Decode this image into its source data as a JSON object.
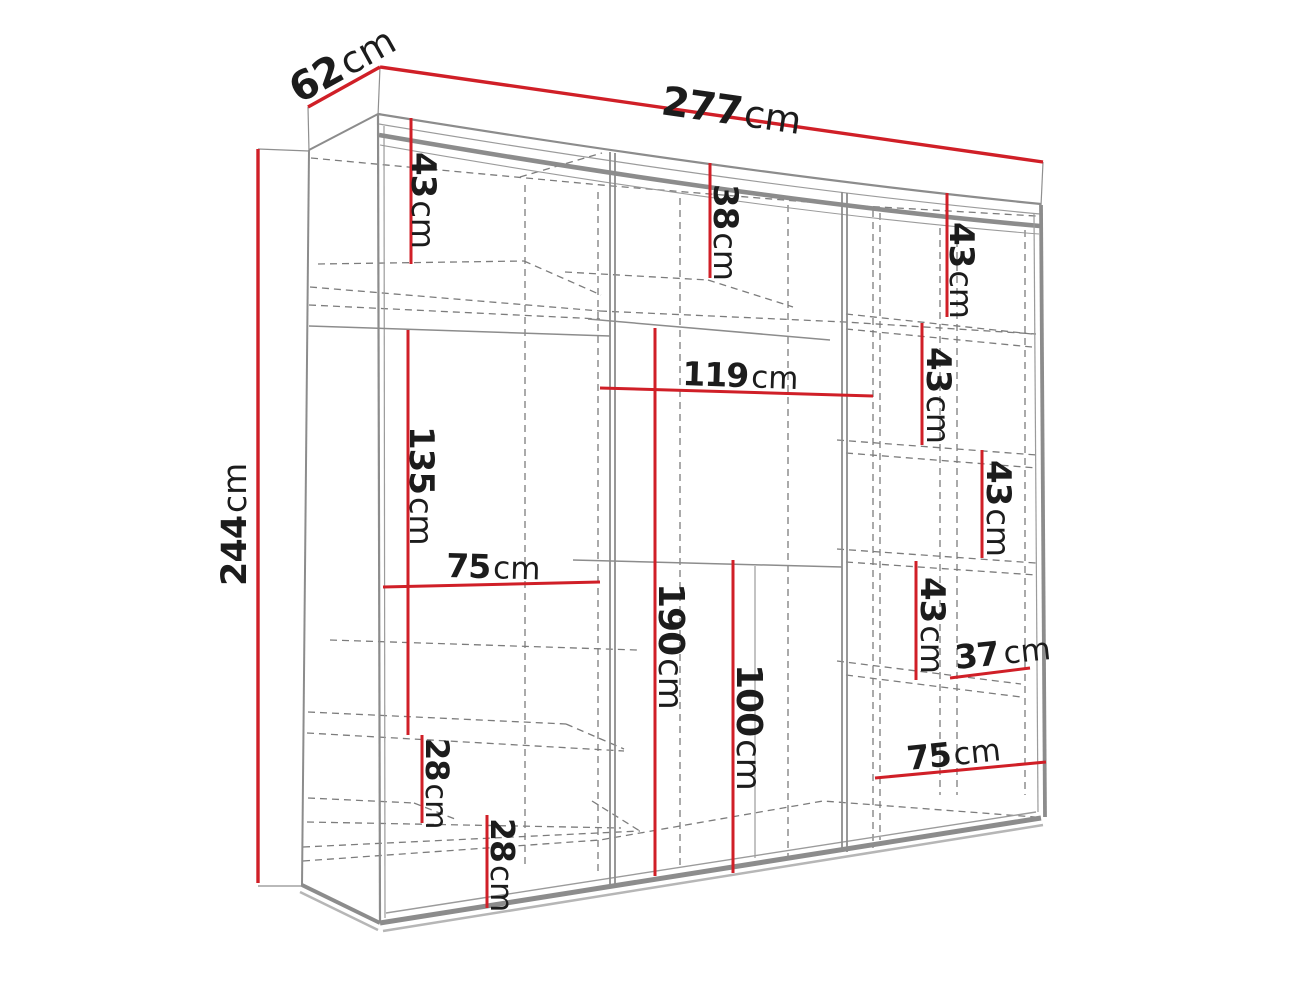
{
  "figure": {
    "kind": "furniture-dimension-diagram",
    "subject": "sliding-door wardrobe perspective drawing with interior shelf layout",
    "unit": "cm",
    "colors": {
      "dimension_red": "#d01f27",
      "frame_gray": "#8c8c8c",
      "dash_gray": "#7c7c7c",
      "text": "#1c1c1c",
      "background": "#ffffff"
    },
    "labels": {
      "width": {
        "num": "277",
        "unit": "cm"
      },
      "depth": {
        "num": "62",
        "unit": "cm"
      },
      "height": {
        "num": "244",
        "unit": "cm"
      },
      "left_top_43": {
        "num": "43",
        "unit": "cm"
      },
      "mid_top_38": {
        "num": "38",
        "unit": "cm"
      },
      "right_43_a": {
        "num": "43",
        "unit": "cm"
      },
      "right_43_b": {
        "num": "43",
        "unit": "cm"
      },
      "right_43_c": {
        "num": "43",
        "unit": "cm"
      },
      "right_43_d": {
        "num": "43",
        "unit": "cm"
      },
      "right_37": {
        "num": "37",
        "unit": "cm"
      },
      "right_75": {
        "num": "75",
        "unit": "cm"
      },
      "mid_119": {
        "num": "119",
        "unit": "cm"
      },
      "left_135": {
        "num": "135",
        "unit": "cm"
      },
      "left_75": {
        "num": "75",
        "unit": "cm"
      },
      "mid_190": {
        "num": "190",
        "unit": "cm"
      },
      "mid_100": {
        "num": "100",
        "unit": "cm"
      },
      "left_28_up": {
        "num": "28",
        "unit": "cm"
      },
      "left_28_low": {
        "num": "28",
        "unit": "cm"
      }
    }
  }
}
